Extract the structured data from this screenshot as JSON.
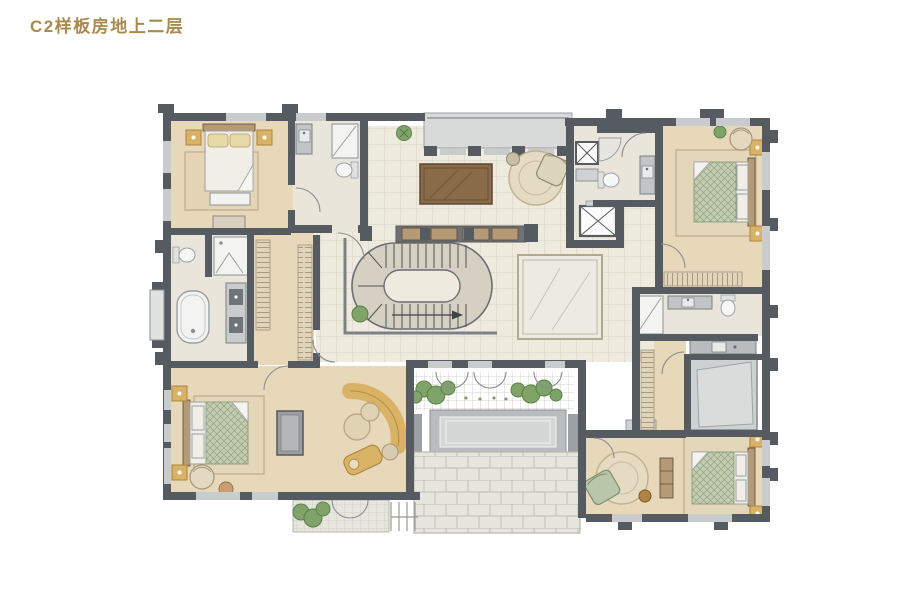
{
  "title": {
    "text": "C2样板房地上二层"
  },
  "palette": {
    "title": "#a8894e",
    "wall": "#565a61",
    "wallLight": "#9aa0a3",
    "glass": "#c9cccc",
    "floorTan": "#e7d8b9",
    "floorCream": "#eeeadd",
    "floorBath": "#e9e5da",
    "slab": "#d8dad9",
    "paving": "#e6e6df",
    "pavingLine": "#c2c2b6",
    "marble": "#eceae2",
    "marbleLine": "#b3a98e",
    "wood": "#8a6b49",
    "woodDark": "#5f4630",
    "woodLight": "#b59a78",
    "gold": "#d9b266",
    "goldDim": "#a9853c",
    "bedGreen": "#c2cdb2",
    "bedGreenLine": "#93a285",
    "linen": "#f0eee6",
    "fixture": "#f3f4f2",
    "fixtureLine": "#9aa0a3",
    "plant": "#7fa368",
    "plantDark": "#5d8049",
    "rug": "#e3d5b5",
    "rugLine": "#c4b493",
    "water": "#d5d7d6",
    "waterFrame": "#b9bdbf"
  }
}
